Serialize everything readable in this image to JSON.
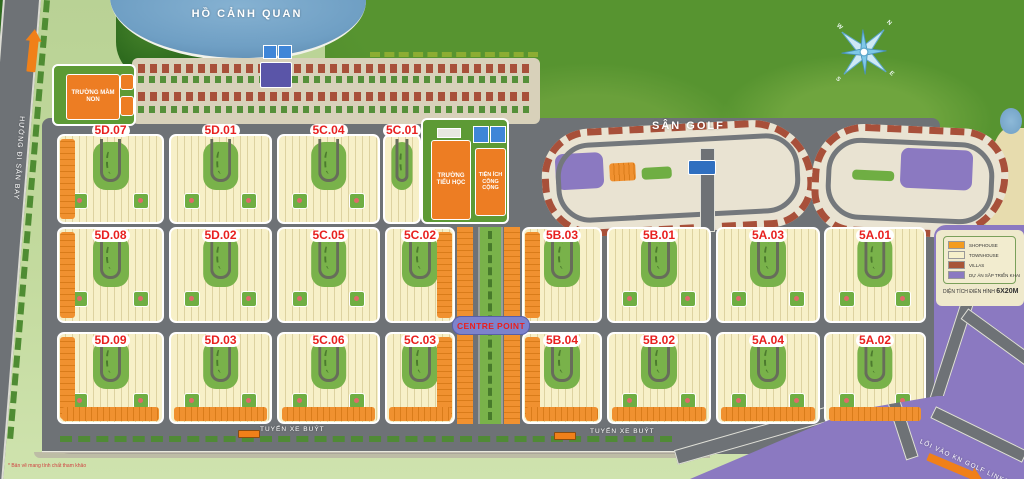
{
  "labels": {
    "lake": "HỒ CẢNH QUAN",
    "golf": "SÂN GOLF",
    "kindergarten": "TRƯỜNG MẦM NON",
    "primary_school": "TRƯỜNG TIỂU HỌC",
    "public_utility": "TIỆN ÍCH CÔNG CỘNG",
    "centre_point": "CENTRE POINT",
    "bus_route": "TUYẾN XE BUÝT",
    "airport_direction": "HƯỚNG ĐI SÂN BAY",
    "golf_entrance": "LỐI VÀO KN GOLF LINKS",
    "disclaimer": "* Bản vẽ mang tính chất tham khảo"
  },
  "compass": {
    "n": "N",
    "e": "E",
    "s": "S",
    "w": "W"
  },
  "blocks": [
    {
      "label": "5D.07"
    },
    {
      "label": "5D.01"
    },
    {
      "label": "5C.04"
    },
    {
      "label": "5C.01"
    },
    {
      "label": "5D.08"
    },
    {
      "label": "5D.02"
    },
    {
      "label": "5C.05"
    },
    {
      "label": "5C.02"
    },
    {
      "label": "5B.03"
    },
    {
      "label": "5B.01"
    },
    {
      "label": "5A.03"
    },
    {
      "label": "5A.01"
    },
    {
      "label": "5D.09"
    },
    {
      "label": "5D.03"
    },
    {
      "label": "5C.06"
    },
    {
      "label": "5C.03"
    },
    {
      "label": "5B.04"
    },
    {
      "label": "5B.02"
    },
    {
      "label": "5A.04"
    },
    {
      "label": "5A.02"
    }
  ],
  "legend": {
    "items": [
      {
        "label": "SHOPHOUSE",
        "color": "#F39C1F"
      },
      {
        "label": "TOWNHOUSE",
        "color": "#F6F0CB"
      },
      {
        "label": "VILLAS",
        "color": "#A85638"
      },
      {
        "label": "DỰ ÁN SẮP TRIỂN KHAI",
        "color": "#8B79C1"
      }
    ],
    "caption_prefix": "DIỆN TÍCH ĐIỂN HÌNH",
    "caption_value": "6X20M"
  },
  "colors": {
    "block_label_red": "#E8201F",
    "road_gray": "#6E7276",
    "purple_zone": "#8B79C1",
    "lake_blue": "#6F9FC4",
    "golf_green": "#4A8727",
    "shophouse_orange": "#F09130",
    "townhouse_cream": "#F6EFC6",
    "villa_red": "#A8503A"
  }
}
